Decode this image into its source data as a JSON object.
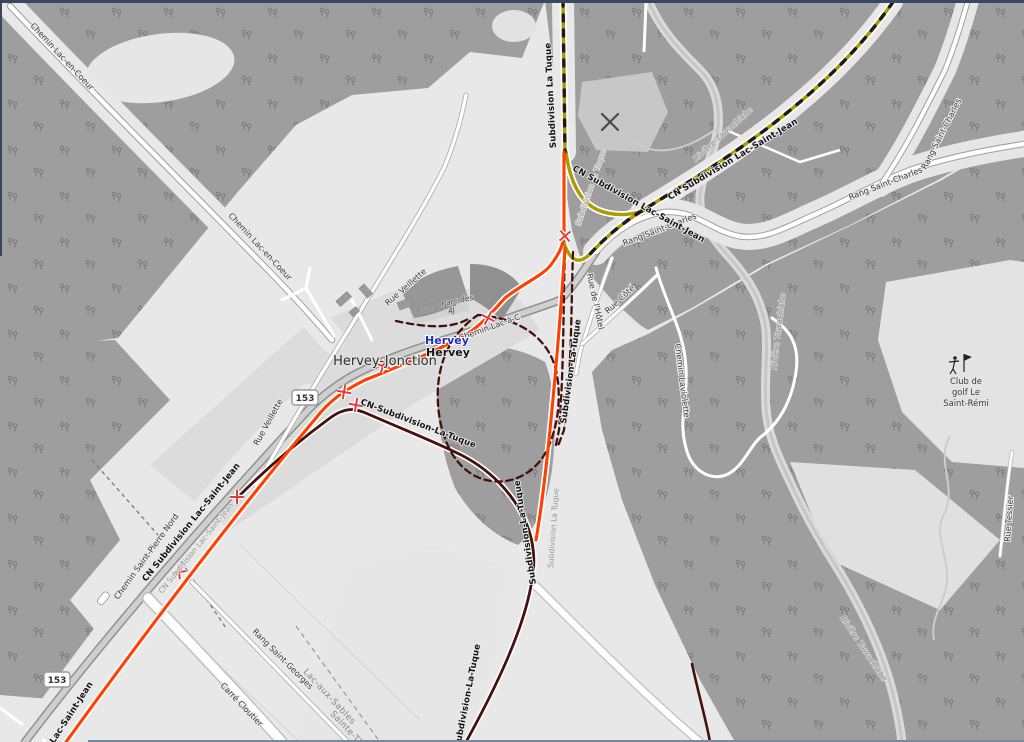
{
  "places": {
    "town": "Hervey-Jonction",
    "station": "Hervey",
    "village": "Hervey",
    "park_line1": "Parc des",
    "park_line2": "4J",
    "golf_line1": "Club de",
    "golf_line2": "golf Le",
    "golf_line3": "Saint-Rémi"
  },
  "railways": {
    "cn_lac_saint_jean": "CN Subdivision Lac-Saint-Jean",
    "cn_la_tuque": "CN-Subdivision-La-Tuque",
    "la_tuque_short": "Subdivision La Tuque",
    "la_tuque_dashed": "Subdivision-La-Tuque",
    "lac_saint_jean_short": "Lac-Saint-Jean"
  },
  "roads": {
    "chemin_lac_en_coeur": "Chemin Lac-en-Coeur",
    "chemin_saint_pierre_nord": "Chemin Saint-Pierre Nord",
    "rue_veillette": "Rue Veillette",
    "chemin_lac_a_c": "Chemin Lac-à-C",
    "rang_saint_charles": "Rang Saint-Charles",
    "rue_de_lhotel": "Rue de l'Hôtel",
    "rue_cote": "Rue Côté",
    "chemin_laviolette": "Chemin Laviolette",
    "rue_tessier": "Rue Tessier",
    "rang_saint_georges": "Rang Saint-Georges",
    "carre_cloutier": "Carré Cloutier",
    "route_153": "153"
  },
  "water": {
    "riviere_tawachiche": "Rivière Tawachiche"
  },
  "boundaries": {
    "lac_aux_sables": "Lac-aux-Sables",
    "sainte_thecle": "Sainte-Thècle"
  },
  "colors": {
    "route_lac_saint_jean": "#ff4000",
    "route_la_tuque": "#45110d",
    "route_lac_saint_jean_east": "#a99b00",
    "station_label": "#1d2fbe",
    "crossing_marker": "#e23c3c",
    "forest": "#9e9e9e",
    "background": "#e8e8e8"
  }
}
